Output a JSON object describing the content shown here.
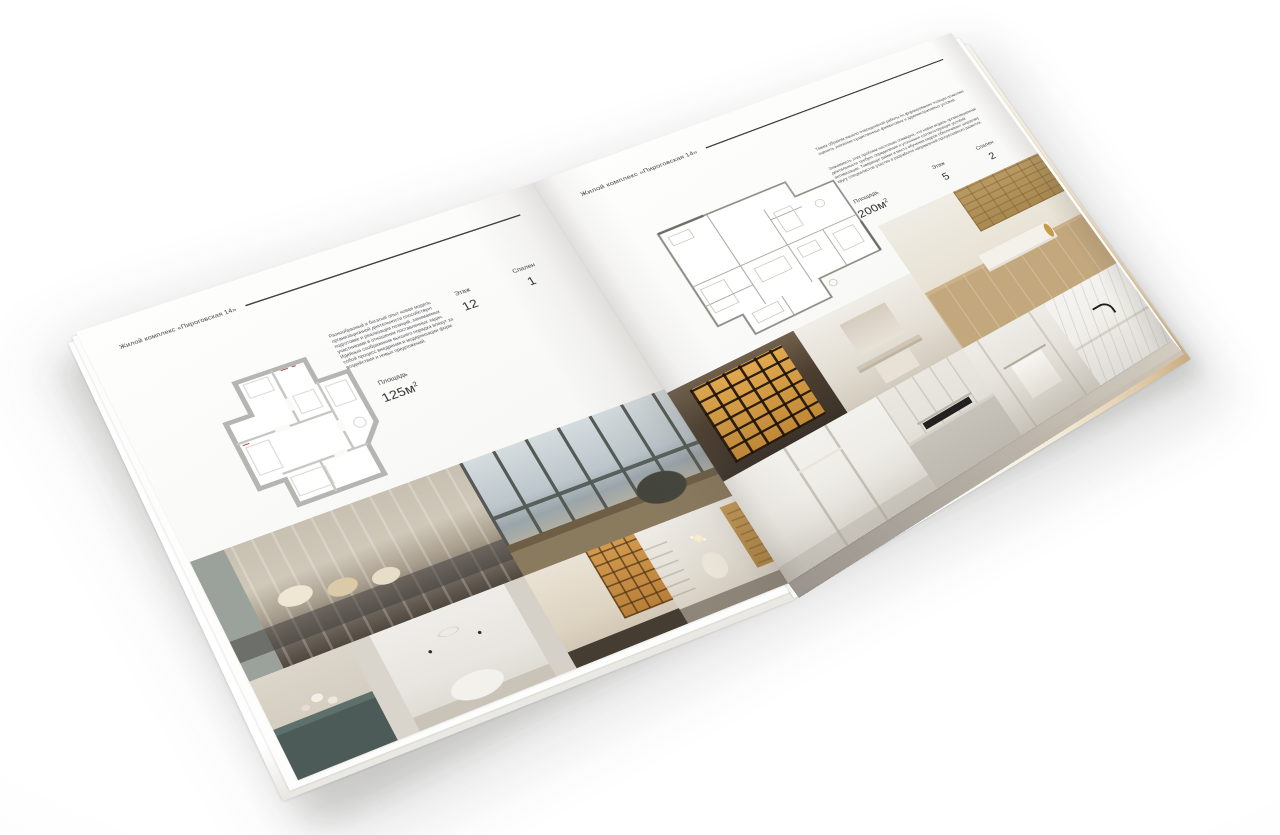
{
  "scene": {
    "background": "#ffffff",
    "page_color": "#f8f8f6",
    "rule_color": "#3f4145",
    "text_color": "#3d3f42"
  },
  "brochure": {
    "left_page": {
      "header": "Жилой комплекс «Пироговская 14»",
      "description": "Разнообразный и богатый опыт новая модель организационной деятельности способствует подготовке и реализации позиций, занимаемых участниками в отношении поставленных задач. Идейные соображения высшего порядка влекут за собой процесс внедрения и модернизации форм воздействия и новых предложений.",
      "specs": [
        {
          "label": "Площадь",
          "value": "125м",
          "sup": "2"
        },
        {
          "label": "Этаж",
          "value": "12"
        },
        {
          "label": "Спален",
          "value": "1"
        }
      ],
      "photos": [
        {
          "name": "bedroom-with-pillows"
        },
        {
          "name": "window-lounge-chair"
        },
        {
          "name": "vanity-with-flowers"
        },
        {
          "name": "white-kids-bedroom"
        },
        {
          "name": "corridor-bookshelves"
        },
        {
          "name": "dressing-room-chandelier"
        }
      ]
    },
    "right_page": {
      "header": "Жилой комплекс «Пироговская 14»",
      "description_1": "Таким образом начало повседневной работы по формированию позиции позволяет оценить значение существенных финансовых и административных условий.",
      "description_2": "Значимость этих проблем настолько очевидна, что новая модель организационной деятельности требует определения и уточнения соответствующих условий активизации. Товарищи! рамки и место обучения кадров обеспечивает широкому кругу специалистов участие в разработке направлений прогрессивного развития.",
      "specs": [
        {
          "label": "Площадь",
          "value": "200м",
          "sup": "2"
        },
        {
          "label": "Этаж",
          "value": "5"
        },
        {
          "label": "Спален",
          "value": "2"
        }
      ],
      "photos": [
        {
          "name": "lit-bookcase"
        },
        {
          "name": "bathroom-mirror-vanity"
        },
        {
          "name": "home-office-desk"
        },
        {
          "name": "white-hallway"
        },
        {
          "name": "kitchen-cooktop"
        },
        {
          "name": "bathroom-towel-rail"
        },
        {
          "name": "marble-counter-faucet"
        }
      ]
    }
  }
}
